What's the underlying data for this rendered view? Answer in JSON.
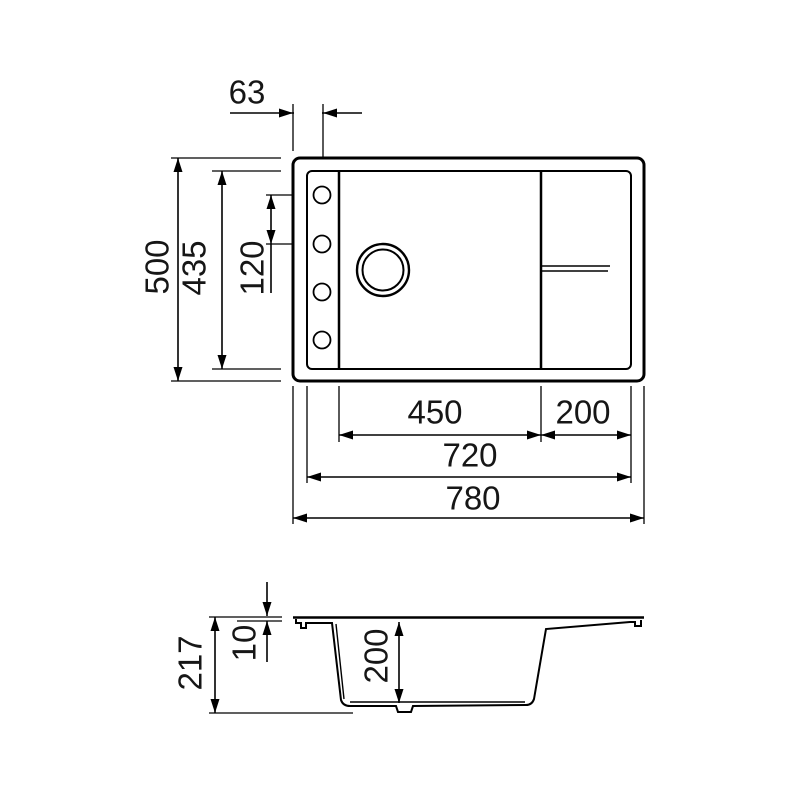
{
  "drawing": {
    "type": "sink-technical-drawing",
    "dims": {
      "hole_offset": "63",
      "overall_front_to_back": "500",
      "rim_inner_front_to_back": "435",
      "hole_spacing": "120",
      "bowl_width": "450",
      "drainer_width": "200",
      "rim_inner_width": "720",
      "overall_width": "780",
      "section_overall_height": "217",
      "rim_thickness": "10",
      "bowl_depth": "200"
    },
    "colors": {
      "line": "#000000",
      "text": "#161616",
      "background": "#ffffff"
    }
  }
}
